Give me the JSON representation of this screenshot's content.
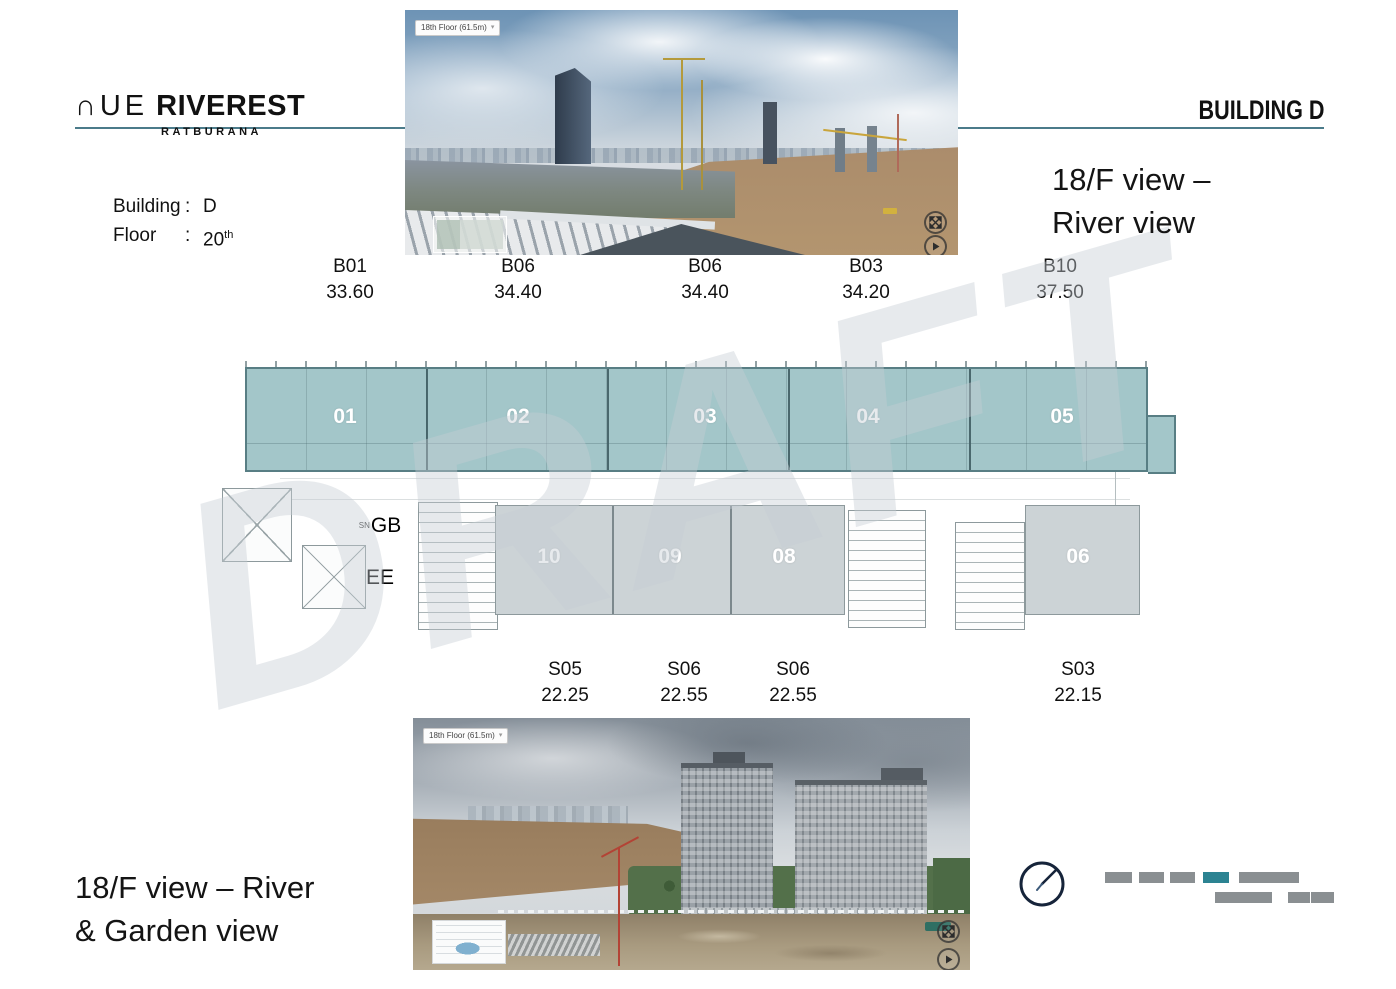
{
  "page": {
    "watermark": "DRAFT"
  },
  "brand": {
    "prefix": "∩UE",
    "name": "RIVEREST",
    "subtitle": "RATBURANA"
  },
  "header": {
    "building_title": "BUILDING D"
  },
  "info": {
    "building_label": "Building",
    "colon": ":",
    "building_value": "D",
    "floor_label": "Floor",
    "floor_value": "20",
    "floor_ordinal": "th"
  },
  "top_view": {
    "badge": "18th Floor (61.5m)",
    "caption_line1": "18/F view –",
    "caption_line2": "River view"
  },
  "bottom_view": {
    "badge": "18th Floor (61.5m)",
    "caption_line1": "18/F view – River",
    "caption_line2": "& Garden view"
  },
  "icons": {
    "dropdown": "▾"
  },
  "units_top": [
    {
      "code": "B01",
      "area": "33.60"
    },
    {
      "code": "B06",
      "area": "34.40"
    },
    {
      "code": "B06",
      "area": "34.40"
    },
    {
      "code": "B03",
      "area": "34.20"
    },
    {
      "code": "B10",
      "area": "37.50"
    }
  ],
  "units_bottom": [
    {
      "code": "S05",
      "area": "22.25"
    },
    {
      "code": "S06",
      "area": "22.55"
    },
    {
      "code": "S06",
      "area": "22.55"
    },
    {
      "code": "S03",
      "area": "22.15"
    }
  ],
  "plan": {
    "upper": [
      "01",
      "02",
      "03",
      "04",
      "05"
    ],
    "lower": [
      "10",
      "09",
      "08",
      "06"
    ],
    "sn": "SN",
    "gb": "GB",
    "ee": "EE"
  },
  "colors": {
    "accent_teal": "#2c8392",
    "plan_teal": "#a3c6c9",
    "plan_gray": "#ccd3d6",
    "rule_teal": "#4b7b8a",
    "bar_gray": "#8a8f92",
    "compass_navy": "#16243a"
  }
}
